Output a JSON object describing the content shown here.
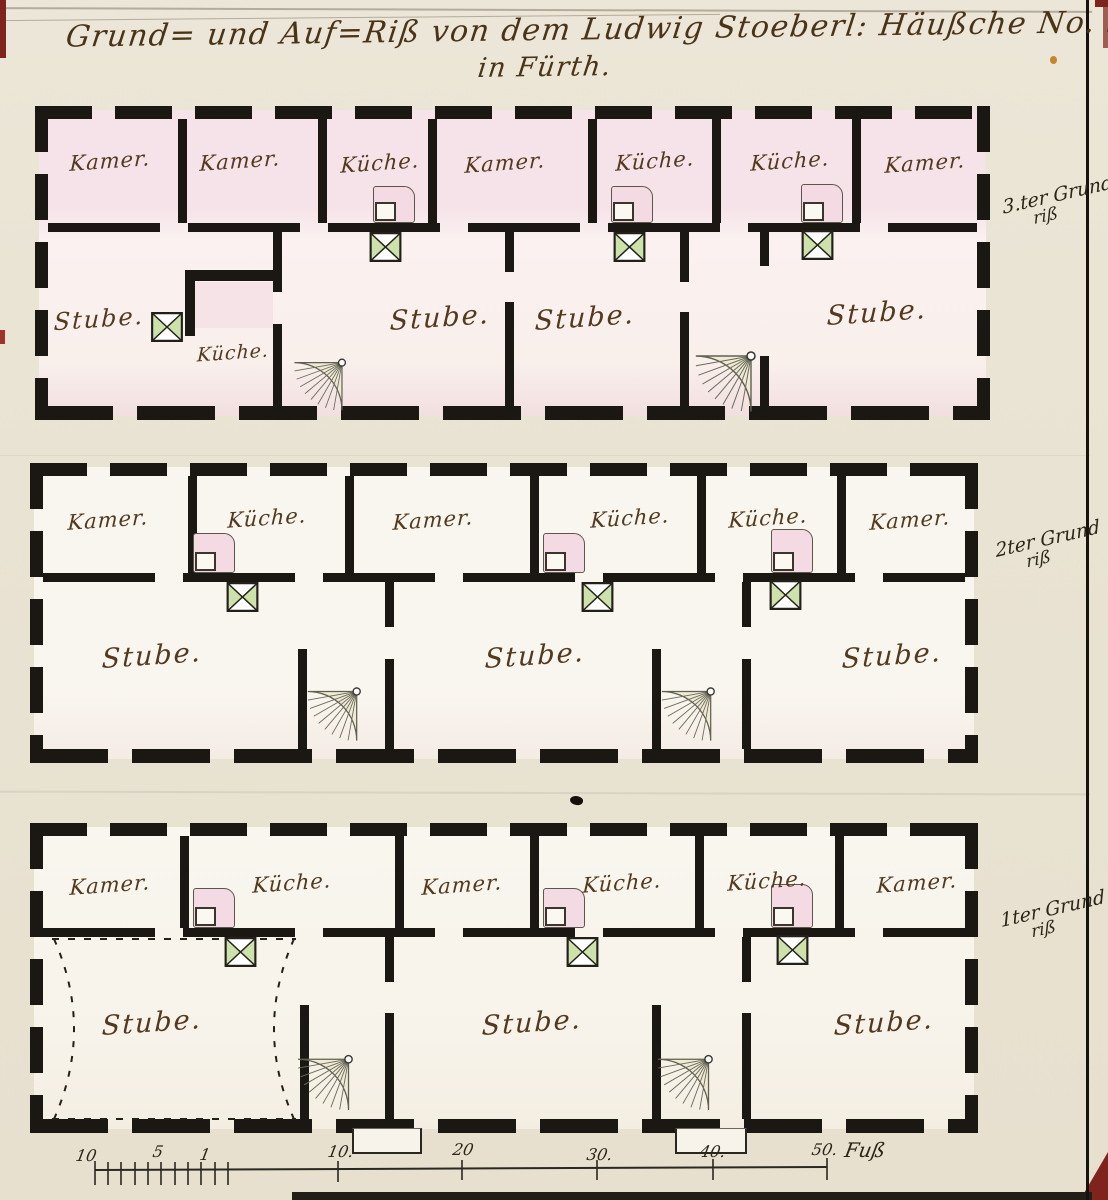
{
  "title": {
    "line1": "Grund= und Auf=Riß von dem Ludwig Stoeberl: Häußche No. 91.",
    "line2": "in Fürth."
  },
  "floors": [
    {
      "annotation": {
        "line1": "3.ter Grund",
        "line2": "riß"
      },
      "rooms": [
        "Kamer.",
        "Kamer.",
        "Küche.",
        "Kamer.",
        "Küche.",
        "Küche.",
        "Kamer.",
        "Stube.",
        "Küche.",
        "Stube.",
        "Stube.",
        "Stube."
      ]
    },
    {
      "annotation": {
        "line1": "2ter Grund",
        "line2": "riß"
      },
      "rooms": [
        "Kamer.",
        "Küche.",
        "Kamer.",
        "Küche.",
        "Küche.",
        "Kamer.",
        "Stube.",
        "Stube.",
        "Stube."
      ]
    },
    {
      "annotation": {
        "line1": "1ter Grund",
        "line2": "riß"
      },
      "rooms": [
        "Kamer.",
        "Küche.",
        "Kamer.",
        "Küche.",
        "Küche.",
        "Kamer.",
        "Stube.",
        "Stube.",
        "Stube."
      ]
    }
  ],
  "scale_bar": {
    "labels": [
      "10",
      "5",
      "1",
      "10.",
      "20",
      "30.",
      "40.",
      "50.",
      "Fuß"
    ]
  },
  "colors": {
    "ink": "#1b1712",
    "script_brown": "#53391e",
    "stove_green": "#cde2ab",
    "chimney_pink": "#f4dbe3",
    "paper": "#e9e3d3",
    "pink_wash": "#f6e4e9"
  }
}
